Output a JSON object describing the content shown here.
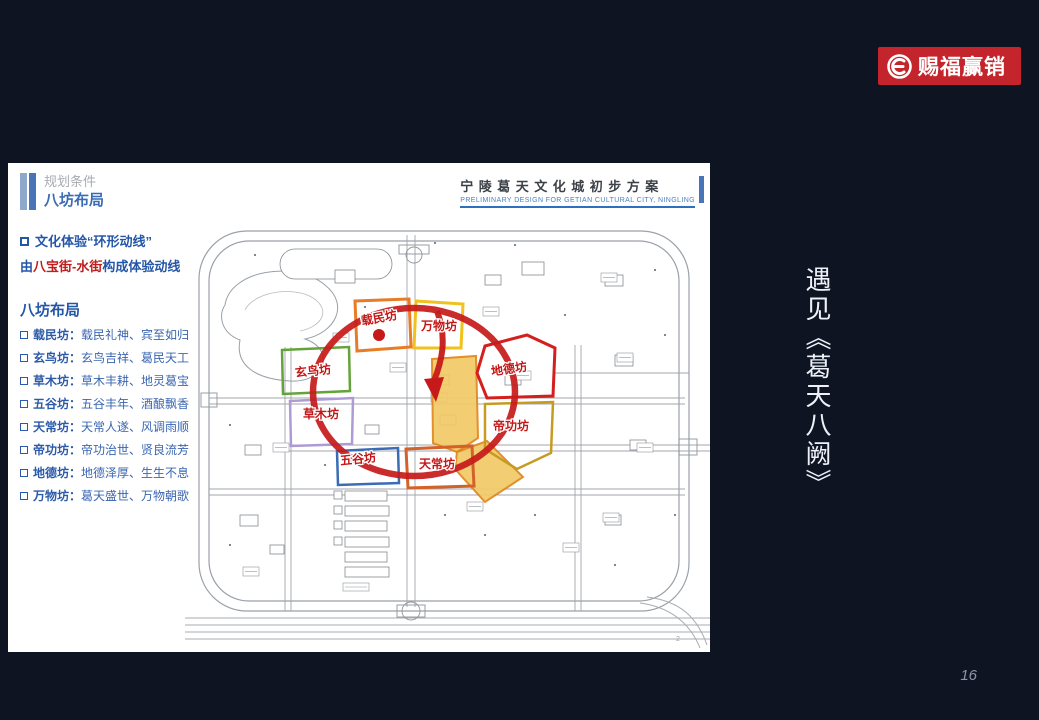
{
  "page": {
    "background": "#0e1422",
    "page_number": "16"
  },
  "logo": {
    "text": "赐福赢销",
    "bg": "#c4242b"
  },
  "side_text": "遇见《葛天八阙》",
  "slide": {
    "header": {
      "eyebrow": "规划条件",
      "title": "八坊布局"
    },
    "doc_title": {
      "zh": "宁陵葛天文化城初步方案",
      "en": "PRELIMINARY DESIGN FOR GETIAN CULTURAL CITY, NINGLING"
    },
    "intro": {
      "line1": "文化体验“环形动线”",
      "line2_prefix": "由",
      "line2_red": "八宝街-水街",
      "line2_suffix": "构成体验动线"
    },
    "list_title": "八坊布局",
    "items": [
      {
        "label": "载民坊：",
        "desc": "载民礼神、宾至如归"
      },
      {
        "label": "玄鸟坊：",
        "desc": "玄鸟吉祥、葛民天工"
      },
      {
        "label": "草木坊：",
        "desc": "草木丰耕、地灵葛宝"
      },
      {
        "label": "五谷坊：",
        "desc": "五谷丰年、酒酿飘香"
      },
      {
        "label": "天常坊：",
        "desc": "天常人遂、风调雨顺"
      },
      {
        "label": "帝功坊：",
        "desc": "帝功治世、贤良流芳"
      },
      {
        "label": "地德坊：",
        "desc": "地德泽厚、生生不息"
      },
      {
        "label": "万物坊：",
        "desc": "葛天盛世、万物朝歌"
      }
    ],
    "map": {
      "page_mark": "2",
      "route_color": "#c61a1a",
      "label_color": "#c41717",
      "water_street_fill": "#f2c967",
      "water_street_border": "#e0861c",
      "zones": [
        {
          "label": "载民坊",
          "color": "#e87c26"
        },
        {
          "label": "万物坊",
          "color": "#f0c11f"
        },
        {
          "label": "玄鸟坊",
          "color": "#63a33a"
        },
        {
          "label": "草木坊",
          "color": "#ae9bd6"
        },
        {
          "label": "地德坊",
          "color": "#d41f1f"
        },
        {
          "label": "帝功坊",
          "color": "#c79b22"
        },
        {
          "label": "五谷坊",
          "color": "#3a6cb5"
        },
        {
          "label": "天常坊",
          "color": "#d2622a"
        }
      ]
    }
  }
}
